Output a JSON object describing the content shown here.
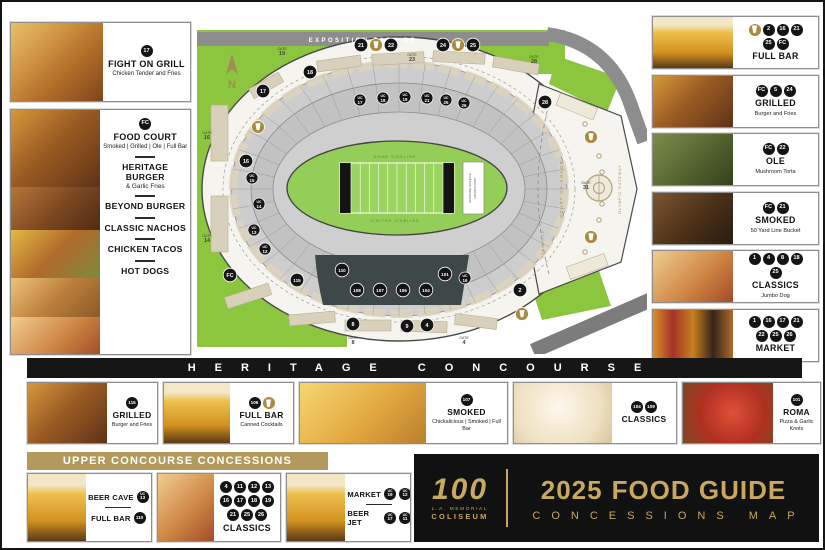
{
  "colors": {
    "gold": "#b3995c",
    "badge_gold": "#a98b3f",
    "park_green": "#8cc63f",
    "field_green": "#94ce58",
    "road_gray": "#8d8d8d",
    "suite_dark": "#3e4849"
  },
  "left_panels": {
    "fight": {
      "badges": [
        "17"
      ],
      "title": "FIGHT ON GRILL",
      "sub": "Chicken Tender and Fries",
      "photo": "tenders"
    },
    "food_court": {
      "badges": [
        "FC"
      ],
      "title": "FOOD COURT",
      "sub": "Smoked | Grilled | Ole | Full Bar",
      "photos": [
        "burger",
        "beyond",
        "nachos",
        "tacos",
        "hotdog"
      ],
      "menu": [
        {
          "title": "HERITAGE BURGER",
          "sub": "& Garlic Fries"
        },
        {
          "title": "BEYOND BURGER",
          "sub": ""
        },
        {
          "title": "CLASSIC NACHOS",
          "sub": ""
        },
        {
          "title": "CHICKEN TACOS",
          "sub": ""
        },
        {
          "title": "HOT DOGS",
          "sub": ""
        }
      ]
    }
  },
  "right_panels": [
    {
      "photo": "beer",
      "badges": [
        "beer",
        "2",
        "16",
        "21",
        "25",
        "FC"
      ],
      "title": "FULL BAR",
      "sub": ""
    },
    {
      "photo": "burger",
      "badges": [
        "FC",
        "5",
        "24"
      ],
      "title": "GRILLED",
      "sub": "Burger and Fries"
    },
    {
      "photo": "torta",
      "badges": [
        "FC",
        "22"
      ],
      "title": "OLE",
      "sub": "Mushroom Torta"
    },
    {
      "photo": "smoked",
      "badges": [
        "FC",
        "21"
      ],
      "title": "SMOKED",
      "sub": "50 Yard Line Bucket"
    },
    {
      "photo": "hotdog",
      "badges": [
        "1",
        "4",
        "8",
        "18",
        "25"
      ],
      "title": "CLASSICS",
      "sub": "Jumbo Dog"
    },
    {
      "photo": "drinks",
      "badges": [
        "1",
        "16",
        "17",
        "21",
        "22",
        "25",
        "26"
      ],
      "title": "MARKET",
      "sub": ""
    }
  ],
  "heritage": {
    "banner": "HERITAGE CONCOURSE",
    "cards": [
      {
        "photo": "burger",
        "badges": [
          "115"
        ],
        "title": "GRILLED",
        "sub": "Burger and Fries"
      },
      {
        "photo": "beer",
        "badges": [
          "106",
          "beer"
        ],
        "title": "FULL BAR",
        "sub": "Canned Cocktails"
      },
      {
        "photo": "mac",
        "badges": [
          "107"
        ],
        "title": "SMOKED",
        "sub": "Chickalicious | Smoked | Full Bar"
      },
      {
        "photo": "popcorn",
        "badges": [
          "104",
          "109"
        ],
        "title": "CLASSICS",
        "sub": ""
      },
      {
        "photo": "pizza",
        "badges": [
          "101"
        ],
        "title": "ROMA",
        "sub": "Pizza & Garlic Knots"
      }
    ]
  },
  "upper": {
    "banner": "UPPER CONCOURSE CONCESSIONS",
    "bar_panel": {
      "photo": "beer",
      "rows": [
        {
          "label": "BEER CAVE",
          "badges": [
            "UC 13"
          ]
        },
        {
          "label": "FULL BAR",
          "badges": [
            "110"
          ]
        }
      ]
    },
    "classics_panel": {
      "photo": "hotdog",
      "badges": [
        "4",
        "11",
        "12",
        "13",
        "16",
        "17",
        "18",
        "19",
        "21",
        "25",
        "26"
      ],
      "title": "CLASSICS"
    },
    "market_panel": {
      "photo": "beer",
      "rows": [
        {
          "label": "MARKET",
          "badges": [
            "UC 19",
            "UC 12"
          ]
        },
        {
          "label": "BEER JET",
          "badges": [
            "UC 17",
            "UC 11"
          ]
        }
      ]
    }
  },
  "logo": {
    "num": "100",
    "org_line1": "L.A. MEMORIAL",
    "org_line2": "COLISEUM",
    "year": "2025",
    "title": "FOOD GUIDE",
    "subtitle": "CONCESSIONS MAP"
  },
  "map": {
    "road_label": "EXPOSITION PARK DR.",
    "compass": "N",
    "field": {
      "home": "HOME SIDELINE",
      "visitor": "VISITOR SIDELINE",
      "endzone_line1": "ENDZONE SUITES &",
      "endzone_line2": "GRANDSTAND"
    },
    "peristyle": {
      "court": "COURT OF HONOR",
      "gateway": "OLYMPIC GATEWAY",
      "name": "PERISTYLE"
    },
    "gate_word": "GATE",
    "gates": [
      {
        "num": "19",
        "x": 85,
        "y": 38
      },
      {
        "num": "23",
        "x": 215,
        "y": 44
      },
      {
        "num": "28",
        "x": 337,
        "y": 46
      },
      {
        "num": "16",
        "x": 10,
        "y": 122
      },
      {
        "num": "14",
        "x": 10,
        "y": 225
      },
      {
        "num": "8",
        "x": 156,
        "y": 327
      },
      {
        "num": "4",
        "x": 267,
        "y": 327
      },
      {
        "num": "31",
        "x": 389,
        "y": 172
      }
    ],
    "markers": [
      {
        "v": "21",
        "x": 164,
        "y": 33
      },
      {
        "v": "beer",
        "x": 179,
        "y": 33
      },
      {
        "v": "22",
        "x": 194,
        "y": 33
      },
      {
        "v": "24",
        "x": 246,
        "y": 33
      },
      {
        "v": "beer",
        "x": 261,
        "y": 33
      },
      {
        "v": "25",
        "x": 276,
        "y": 33
      },
      {
        "v": "17",
        "x": 66,
        "y": 79
      },
      {
        "v": "18",
        "x": 113,
        "y": 60
      },
      {
        "v": "beer",
        "x": 61,
        "y": 115
      },
      {
        "v": "16",
        "x": 49,
        "y": 149
      },
      {
        "v": "FC",
        "x": 33,
        "y": 263
      },
      {
        "v": "28",
        "x": 348,
        "y": 90
      },
      {
        "v": "UC 17",
        "x": 163,
        "y": 88
      },
      {
        "v": "UC 18",
        "x": 186,
        "y": 86
      },
      {
        "v": "UC 19",
        "x": 208,
        "y": 85
      },
      {
        "v": "UC 21",
        "x": 230,
        "y": 86
      },
      {
        "v": "UC 25",
        "x": 249,
        "y": 88
      },
      {
        "v": "UC 26",
        "x": 267,
        "y": 91
      },
      {
        "v": "UC 15",
        "x": 55,
        "y": 166
      },
      {
        "v": "UC 14",
        "x": 62,
        "y": 192
      },
      {
        "v": "UC 13",
        "x": 57,
        "y": 218
      },
      {
        "v": "UC 12",
        "x": 68,
        "y": 237
      },
      {
        "v": "UC 16",
        "x": 268,
        "y": 266
      },
      {
        "v": "115",
        "x": 100,
        "y": 268
      },
      {
        "v": "110",
        "x": 145,
        "y": 258
      },
      {
        "v": "108",
        "x": 160,
        "y": 278
      },
      {
        "v": "107",
        "x": 183,
        "y": 278
      },
      {
        "v": "106",
        "x": 206,
        "y": 278
      },
      {
        "v": "104",
        "x": 229,
        "y": 278
      },
      {
        "v": "101",
        "x": 248,
        "y": 262
      },
      {
        "v": "2",
        "x": 323,
        "y": 278
      },
      {
        "v": "beer",
        "x": 325,
        "y": 302
      },
      {
        "v": "8",
        "x": 156,
        "y": 312
      },
      {
        "v": "9",
        "x": 210,
        "y": 314
      },
      {
        "v": "4",
        "x": 230,
        "y": 313
      },
      {
        "v": "beer",
        "x": 394,
        "y": 125
      },
      {
        "v": "beer",
        "x": 394,
        "y": 225
      }
    ]
  }
}
